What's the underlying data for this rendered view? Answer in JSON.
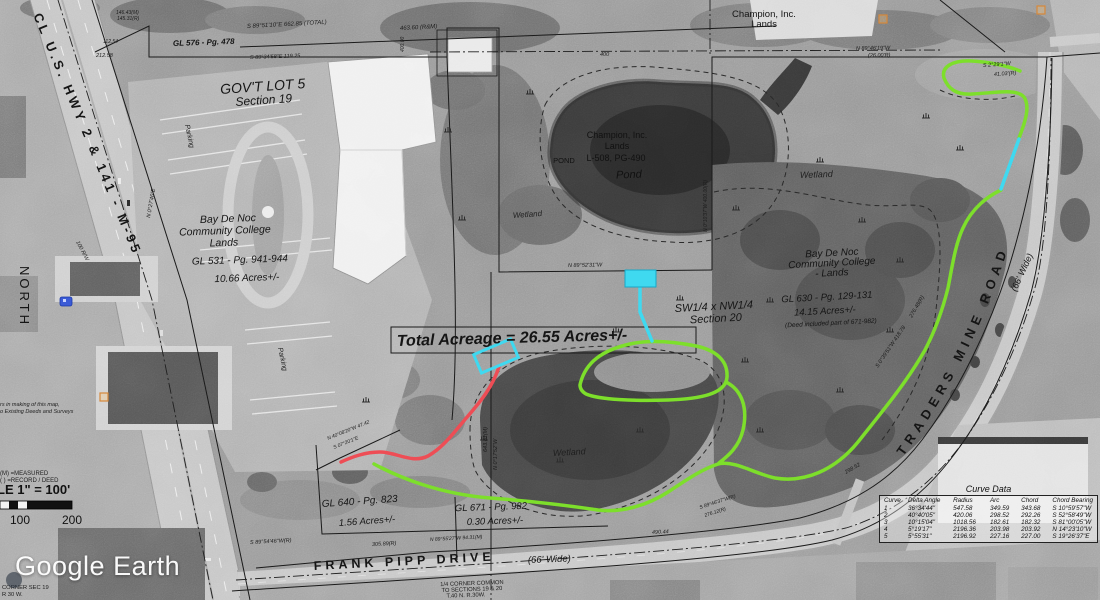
{
  "app": {
    "watermark": "Google Earth"
  },
  "labels": {
    "highway": "CL  U.S.  HWY  2  &  141  -  M-95",
    "north": "NORTH",
    "govt_lot": "GOV'T LOT 5",
    "govt_lot_section": "Section 19",
    "gl576": "GL 576 - Pg. 478",
    "college_w": [
      "Bay De Noc",
      "Community College",
      "Lands"
    ],
    "college_w_gl": "GL 531 - Pg. 941-944",
    "college_w_acres": "10.66 Acres+/-",
    "champion_ne": [
      "Champion, Inc.",
      "Lands"
    ],
    "champion_pond": [
      "Champion, Inc.",
      "Lands",
      "L-508, PG-490"
    ],
    "pond_small": "POND",
    "pond": "Pond",
    "wetland_nw": "Wetland",
    "wetland_ne": "Wetland",
    "wetland_s": "Wetland",
    "college_e": [
      "Bay De Noc",
      "Community College",
      "- Lands"
    ],
    "college_e_gl": "GL 630 - Pg. 129-131",
    "college_e_acres": "14.15 Acres+/-",
    "college_e_deed": "(Deed included part of 671-982)",
    "quarter": [
      "SW1/4 x NW1/4",
      "Section 20"
    ],
    "total_acreage": "Total Acreage  =  26.55 Acres+/-",
    "traders_road": "TRADERS   MINE   ROAD",
    "traders_wide": "(66' Wide)",
    "frank_pipp": "FRANK   PIPP   DRIVE",
    "frank_wide": "(66' Wide)",
    "gl640": "GL 640 - Pg. 823",
    "gl640_acres": "1.56 Acres+/-",
    "gl671": "GL 671 - Pg. 982",
    "gl671_acres": "0.30   Acres+/-",
    "parking_w": "Parking",
    "parking_s": "Parking",
    "corner_note": [
      "1/4 CORNER COMMON",
      "TO SECTIONS 19 & 20",
      "T.40 N. R.30W."
    ],
    "corner_sw": [
      "CORNER SEC 19",
      "R 30 W."
    ],
    "legend_measured": "(M) =MEASURED",
    "legend_record": "( ) =RECORD / DEED",
    "disclaimer": [
      "rs in making of this map,",
      "o Existing Deeds and Surveys"
    ]
  },
  "scalebar": {
    "text": "LE 1\" = 100'",
    "tick_100": "100",
    "tick_200": "200"
  },
  "curve_table": {
    "title": "Curve Data",
    "headers": [
      "Curve",
      "Delta Angle",
      "Radius",
      "Arc",
      "Chord",
      "Chord Bearing"
    ],
    "rows": [
      [
        "1",
        "36°34'44\"",
        "547.58",
        "349.59",
        "343.68",
        "S 10°59'57\"W"
      ],
      [
        "2",
        "40°40'05\"",
        "420.06",
        "298.52",
        "292.26",
        "S 52°58'49\"W"
      ],
      [
        "3",
        "10°15'04\"",
        "1018.56",
        "182.61",
        "182.32",
        "S 81°00'05\"W"
      ],
      [
        "4",
        "5°19'17\"",
        "2196.36",
        "203.98",
        "203.92",
        "N 14°23'10\"W"
      ],
      [
        "5",
        "5°55'31\"",
        "2196.92",
        "227.16",
        "227.00",
        "S 19°26'37\"E"
      ]
    ]
  },
  "annotations": [
    {
      "t": "S 89°51'10\"E   662.85 (TOTAL)",
      "x": 247,
      "y": 28,
      "r": -3,
      "s": 6
    },
    {
      "t": "463.60 (R&M)",
      "x": 400,
      "y": 30,
      "r": -3,
      "s": 6
    },
    {
      "t": "S 89°34'58\"E  119.25",
      "x": 250,
      "y": 59,
      "r": -2,
      "s": 5.5
    },
    {
      "t": "212.58",
      "x": 96,
      "y": 57,
      "r": 0,
      "s": 5.5
    },
    {
      "t": "146.43(M)",
      "x": 116,
      "y": 14,
      "r": 0,
      "s": 5
    },
    {
      "t": "145.31(R)",
      "x": 117,
      "y": 20,
      "r": 0,
      "s": 5
    },
    {
      "t": "112.54",
      "x": 103,
      "y": 43,
      "r": 0,
      "s": 5
    },
    {
      "t": "N 89°46'19\"W",
      "x": 856,
      "y": 50,
      "r": -1,
      "s": 5.5
    },
    {
      "t": "(26.00'R)",
      "x": 868,
      "y": 57,
      "r": -1,
      "s": 5.5
    },
    {
      "t": "S 2°29'1\"W",
      "x": 983,
      "y": 67,
      "r": -4,
      "s": 5.5
    },
    {
      "t": "41.03'(R)",
      "x": 994,
      "y": 76,
      "r": -4,
      "s": 5.5
    },
    {
      "t": "N 89°52'31\"W",
      "x": 568,
      "y": 267,
      "r": -1,
      "s": 5.5
    },
    {
      "t": "N 0°17'52\"W",
      "x": 497,
      "y": 470,
      "r": -90,
      "s": 5.5
    },
    {
      "t": "643.81(M)",
      "x": 487,
      "y": 452,
      "r": -90,
      "s": 5.5
    },
    {
      "t": "N 0°10'37\"W  400.00(R)",
      "x": 707,
      "y": 232,
      "r": -90,
      "s": 5
    },
    {
      "t": "400.00",
      "x": 404,
      "y": 52,
      "r": -90,
      "s": 5
    },
    {
      "t": "400",
      "x": 600,
      "y": 56,
      "r": 0,
      "s": 5.5
    },
    {
      "t": "S 0°39'51\"W  418.78",
      "x": 878,
      "y": 368,
      "r": -56,
      "s": 5.5
    },
    {
      "t": "276.48(R)",
      "x": 912,
      "y": 318,
      "r": -60,
      "s": 5.5
    },
    {
      "t": "298.52",
      "x": 846,
      "y": 474,
      "r": -30,
      "s": 5.5
    },
    {
      "t": "S 89°54'46\"W(R)",
      "x": 250,
      "y": 544,
      "r": -3,
      "s": 5.5
    },
    {
      "t": "305.89(R)",
      "x": 372,
      "y": 546,
      "r": -3,
      "s": 5.5
    },
    {
      "t": "N 89°55'27\"W  94.31(M)",
      "x": 430,
      "y": 541,
      "r": -3,
      "s": 5
    },
    {
      "t": "490.44",
      "x": 652,
      "y": 534,
      "r": -3,
      "s": 5.5
    },
    {
      "t": "S 89°46'37\"W(R)",
      "x": 700,
      "y": 509,
      "r": -18,
      "s": 5
    },
    {
      "t": "276.12(R)",
      "x": 705,
      "y": 517,
      "r": -18,
      "s": 5
    },
    {
      "t": "100 R/W",
      "x": 76,
      "y": 242,
      "r": 62,
      "s": 5.5
    },
    {
      "t": "N 0°27'46\"E",
      "x": 150,
      "y": 218,
      "r": -80,
      "s": 5.5
    },
    {
      "t": "N 40°08'20\"W 47.42",
      "x": 328,
      "y": 440,
      "r": -22,
      "s": 5
    },
    {
      "t": "S 07°20'1\"E",
      "x": 334,
      "y": 449,
      "r": -22,
      "s": 5
    }
  ],
  "colors": {
    "trail_green": "#7ddf2b",
    "trail_red": "#ee4d55",
    "trail_cyan": "#3fd9f0",
    "survey": "#1a1a1a"
  }
}
